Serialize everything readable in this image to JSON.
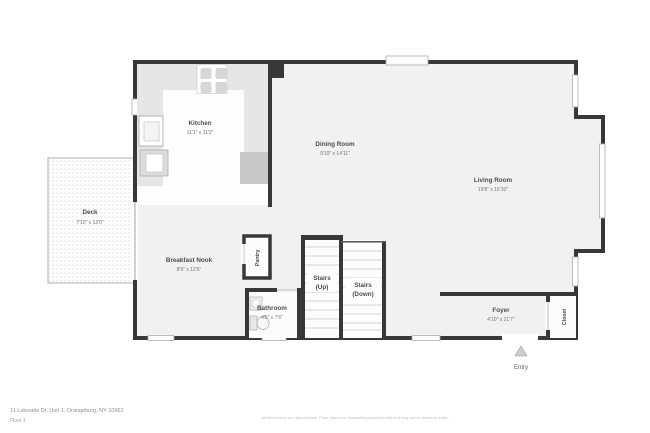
{
  "plan": {
    "rooms": {
      "kitchen": {
        "label": "Kitchen",
        "dims": "11'1\" x 11'3\""
      },
      "dining_room": {
        "label": "Dining Room",
        "dims": "9'10\" x 14'11\""
      },
      "living_room": {
        "label": "Living Room",
        "dims": "19'8\" x 16'10\""
      },
      "deck": {
        "label": "Deck",
        "dims": "7'10\" x 12'0\""
      },
      "breakfast_nook": {
        "label": "Breakfast Nook",
        "dims": "8'9\" x 12'6\""
      },
      "pantry": {
        "label": "Pantry"
      },
      "bathroom": {
        "label": "Bathroom",
        "dims": "4'5\" x 7'6\""
      },
      "stairs_up": {
        "label": "Stairs",
        "sub": "(Up)"
      },
      "stairs_down": {
        "label": "Stairs",
        "sub": "(Down)"
      },
      "foyer": {
        "label": "Foyer",
        "dims": "4'10\" x 21'7\""
      },
      "closet": {
        "label": "Closet"
      },
      "entry": {
        "label": "Entry"
      }
    },
    "colors": {
      "wall": "#383838",
      "floor": "#f1f1f1",
      "counter": "#e6e6e6",
      "fixture_outline": "#a8a8a8",
      "window": "#c4c4c4",
      "tread": "#d2d2d2"
    },
    "footer": {
      "address": "11 Lakeside Dr, Unit 1, Orangeburg, NY 10962",
      "floor": "Floor 1",
      "disclaimer": "All dimensions are approximate. Floor plan is for illustration purposes only and may not be drawn to scale."
    }
  }
}
